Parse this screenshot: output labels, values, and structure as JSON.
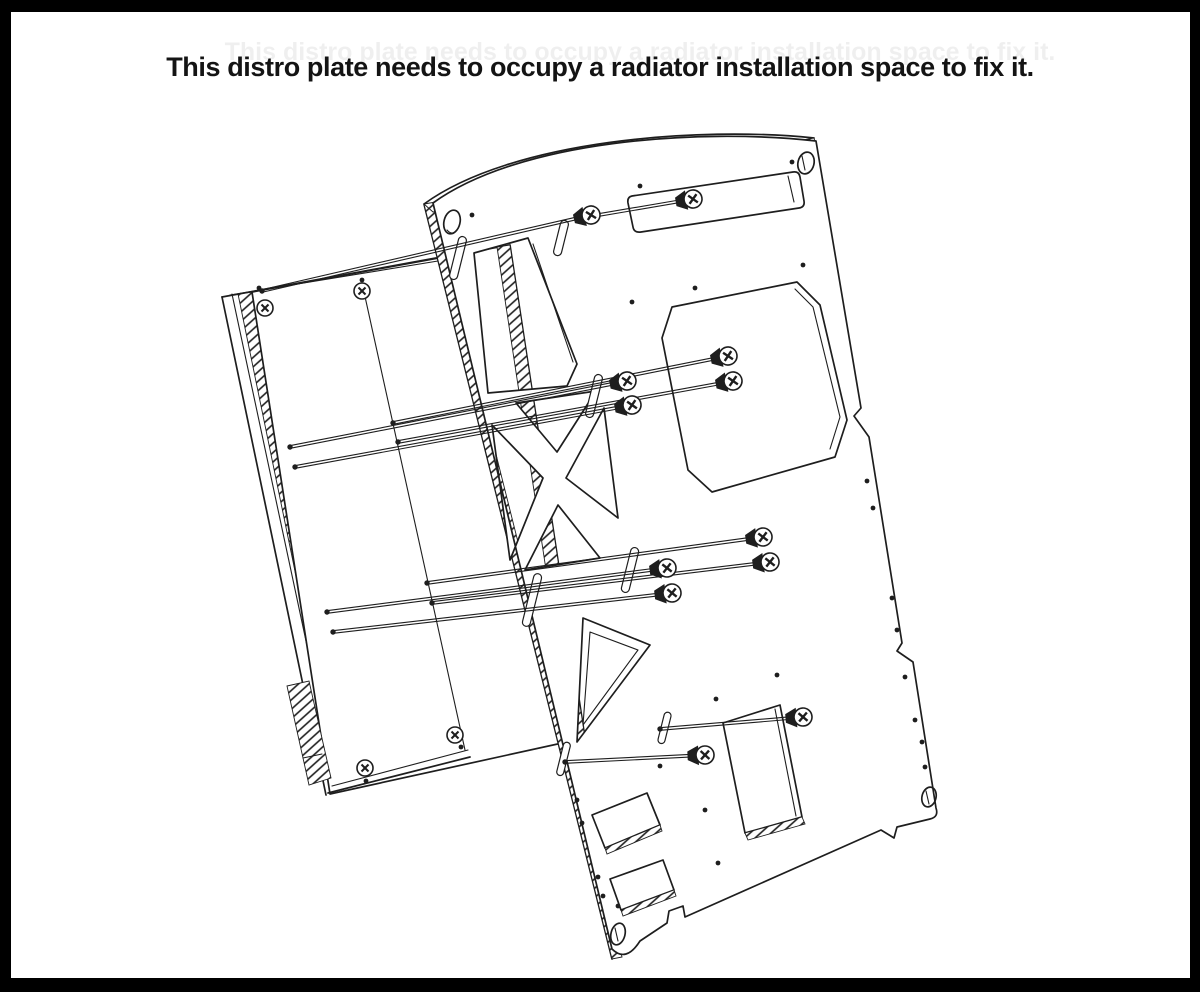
{
  "caption": {
    "text": "This distro plate needs to occupy a radiator installation space to fix it.",
    "ghost_text": "This distro plate needs to occupy a radiator installation space to fix it."
  },
  "frame": {
    "border_color": "#000000"
  },
  "drawing": {
    "line_color": "#1e1e1e",
    "background": "#ffffff",
    "parts": {
      "front_plate": "distro-plate",
      "back_plate": "radiator-mount-plate"
    },
    "screws": {
      "long": [
        {
          "tip": [
            587,
            217
          ],
          "head": [
            693,
            199
          ]
        },
        {
          "tip": [
            262,
            291
          ],
          "head": [
            591,
            215
          ]
        },
        {
          "tip": [
            393,
            423
          ],
          "head": [
            728,
            356
          ]
        },
        {
          "tip": [
            398,
            442
          ],
          "head": [
            733,
            381
          ]
        },
        {
          "tip": [
            290,
            447
          ],
          "head": [
            627,
            381
          ]
        },
        {
          "tip": [
            295,
            467
          ],
          "head": [
            632,
            405
          ]
        },
        {
          "tip": [
            427,
            583
          ],
          "head": [
            763,
            537
          ]
        },
        {
          "tip": [
            432,
            603
          ],
          "head": [
            770,
            562
          ]
        },
        {
          "tip": [
            327,
            612
          ],
          "head": [
            667,
            568
          ]
        },
        {
          "tip": [
            333,
            632
          ],
          "head": [
            672,
            593
          ]
        },
        {
          "tip": [
            660,
            729
          ],
          "head": [
            803,
            717
          ]
        },
        {
          "tip": [
            565,
            762
          ],
          "head": [
            705,
            755
          ]
        }
      ],
      "corner": [
        {
          "at": [
            265,
            308
          ],
          "tick": [
            259,
            288
          ]
        },
        {
          "at": [
            362,
            291
          ],
          "tick": [
            362,
            280
          ]
        },
        {
          "at": [
            365,
            768
          ],
          "tick": [
            366,
            781
          ]
        },
        {
          "at": [
            455,
            735
          ],
          "tick": [
            461,
            747
          ]
        }
      ]
    }
  }
}
